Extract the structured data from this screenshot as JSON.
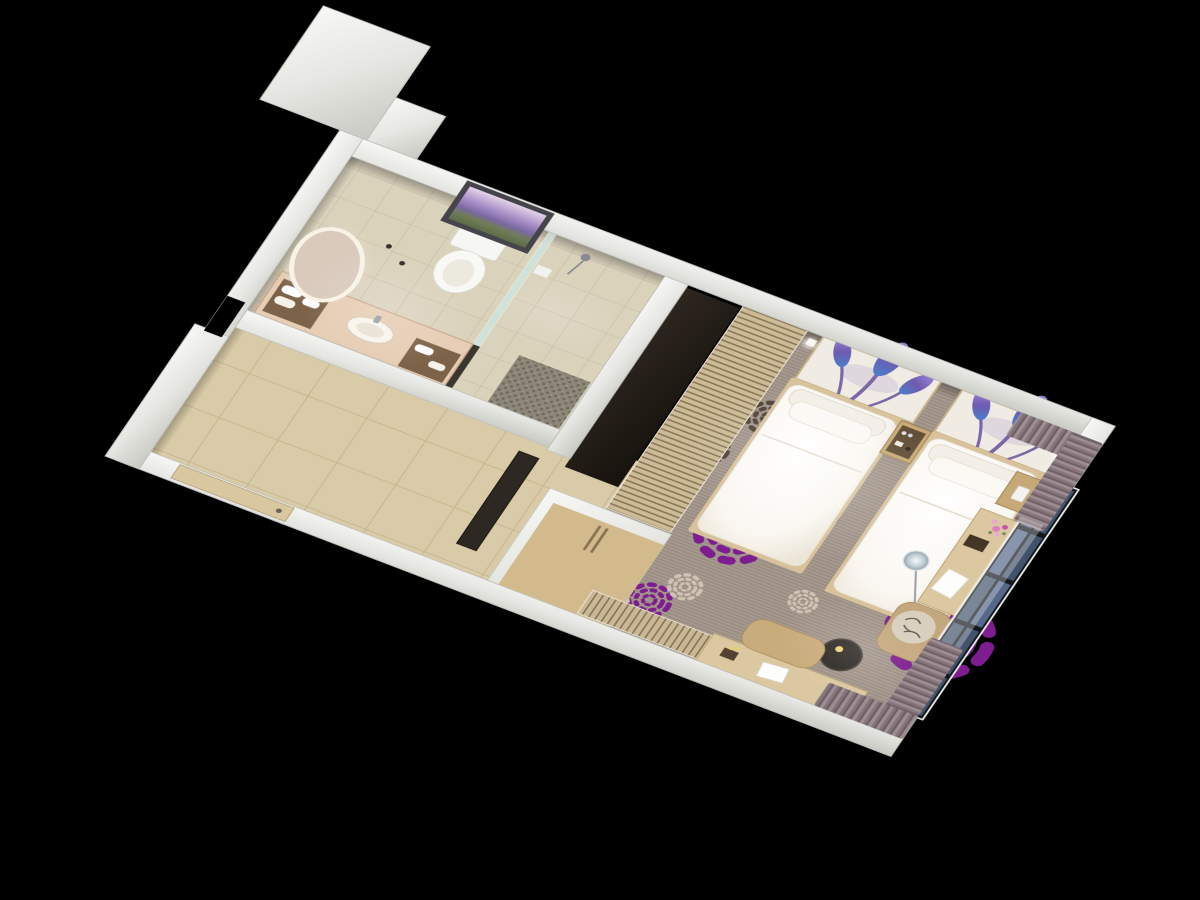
{
  "scene": {
    "type": "3d-cutaway-floor-plan-render",
    "background": "#000000",
    "areas": [
      "bathroom",
      "entry-hall",
      "wardrobe",
      "bedroom"
    ],
    "furniture": [
      "oval-backlit-mirror",
      "vanity-counter-with-basin",
      "towel-niches",
      "toilet",
      "lavender-field-wall-art",
      "walk-in-shower",
      "glass-partition",
      "pebble-shower-mat",
      "entry-door",
      "full-height-mirror-panel",
      "wardrobe-cabinet",
      "slatted-wood-screen",
      "twin-bed-1",
      "twin-bed-2",
      "headboard-art-panel-1",
      "headboard-art-panel-2",
      "minibar-nightstand",
      "bedside-table-with-phone",
      "wall-sconce-left",
      "wall-sconce-right",
      "dressing-desk-with-flowers",
      "glass-globe-floor-lamp",
      "lounge-chair",
      "round-side-table",
      "slatted-tv-console",
      "writing-desk",
      "bench-cushion",
      "window-wall",
      "curtain-panels",
      "sheer-curtain",
      "service-shaft-block"
    ],
    "carpet_motifs": [
      "purple-dandelion-bursts",
      "dark-brown-bursts",
      "cream-bursts"
    ]
  },
  "palette": {
    "background": "#000000",
    "wallEdge": "#bfbfba",
    "tileBath": "#dbd2bc",
    "tileHall": "#d9cba7",
    "grout": "#c3b38d",
    "carpet": "#a3958a",
    "burstPurple": "#7d1d8f",
    "burstDark": "#4f4237",
    "burstCream": "#cfc3b2",
    "wood": "#c6a976",
    "woodLight": "#dcc8a0",
    "woodDark": "#8a7352",
    "duvet": "#fbfaf6",
    "pillow": "#f3efe6",
    "platform": "#d8c29b",
    "curtain": "#9d8e94",
    "curtainDark": "#6f6065",
    "glass": "#42526b",
    "frameDark": "#14181d",
    "counter": "#e6cdb4",
    "niche": "#7c6248",
    "mirrorFace": "#d9cabc",
    "doorLeaf": "#d9c7a0",
    "panelDark": "#2e2720",
    "screenSlat": "#cdbb97"
  }
}
